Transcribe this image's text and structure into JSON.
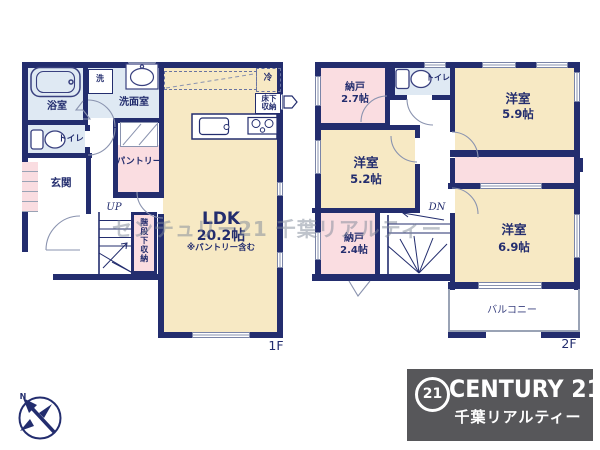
{
  "watermark": "センチュリー21 千葉リアルティー",
  "f1": {
    "tag": "1F",
    "bath": "浴室",
    "washer": "洗",
    "washroom": "洗面室",
    "toilet": "トイレ",
    "entrance": "玄関",
    "pantry": "パントリー",
    "up": "UP",
    "under_stairs_storage": "階段下収納",
    "ldk_name": "LDK",
    "ldk_size": "20.2帖",
    "ldk_note": "※パントリー含む",
    "fridge": "冷",
    "floor_storage": "床下収納"
  },
  "f2": {
    "tag": "2F",
    "storage_a_name": "納戸",
    "storage_a_size": "2.7帖",
    "toilet": "トイレ",
    "room_a_name": "洋室",
    "room_a_size": "5.9帖",
    "room_b_name": "洋室",
    "room_b_size": "5.2帖",
    "dn": "DN",
    "storage_b_name": "納戸",
    "storage_b_size": "2.4帖",
    "room_c_name": "洋室",
    "room_c_size": "6.9帖",
    "balcony": "バルコニー"
  },
  "compass": {
    "north": "N"
  },
  "brand": {
    "logo_number": "21",
    "name": "CENTURY 21",
    "subtitle": "千葉リアルティー",
    "bg_color": "#57575a"
  },
  "colors": {
    "wall": "#232d6e",
    "room_cream": "#f7e9c4",
    "room_pink": "#fadde1",
    "room_blue": "#dfe9f3"
  }
}
